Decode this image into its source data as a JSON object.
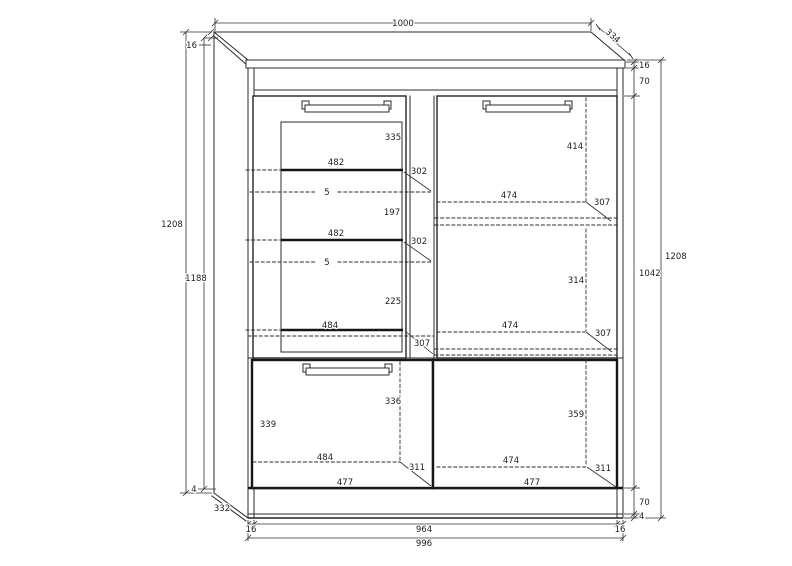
{
  "drawing": {
    "description": "Technical dimension drawing of a two-door display cabinet (vitrine) with glass-door section and shelves",
    "background": "#ffffff",
    "line_color": "#2b2b2b",
    "dims": {
      "top": {
        "width": "1000",
        "depth": "334",
        "panel_thickness": "16"
      },
      "left": {
        "total_height": "1208",
        "inner_height": "1188",
        "base_gap": "4",
        "side_depth": "332"
      },
      "right": {
        "panel_thickness": "16",
        "top_rail": "70",
        "interior_height": "1042",
        "total_height": "1208",
        "bottom_rail": "70",
        "base_gap": "4"
      },
      "bottom": {
        "left_panel": "16",
        "interior_width": "964",
        "right_panel": "16",
        "total_width": "996"
      },
      "glass_section": {
        "top_space": "335",
        "shelf1_width": "482",
        "shelf1_depth": "302",
        "shelf1_glass": "5",
        "mid_space": "197",
        "shelf2_width": "482",
        "shelf2_depth": "302",
        "shelf2_glass": "5",
        "bottom_space": "225",
        "bottom_width": "484",
        "bottom_depth": "307"
      },
      "right_section": {
        "top_space": "414",
        "shelf1_width": "474",
        "shelf1_depth": "307",
        "mid_space": "314",
        "shelf2_width": "474",
        "shelf2_depth": "307",
        "bottom_space": "359",
        "shelf3_width": "474",
        "shelf3_depth": "311",
        "door_width": "477"
      },
      "lower_left_section": {
        "top_space": "336",
        "side_space": "339",
        "interior_width": "484",
        "depth": "311",
        "door_width": "477"
      }
    }
  }
}
